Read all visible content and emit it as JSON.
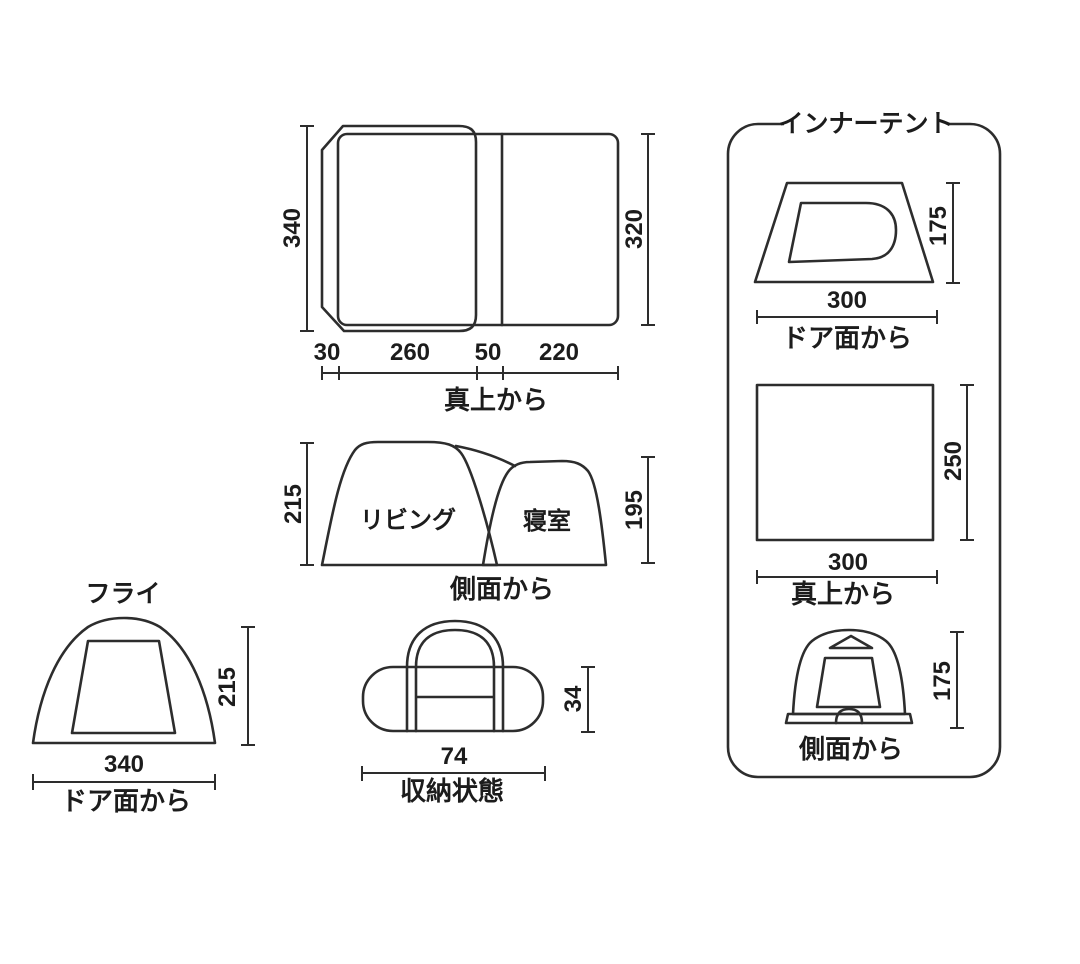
{
  "page": {
    "background": "#ffffff",
    "line_color": "#2d2d2d",
    "text_color": "#1c1c1c"
  },
  "main_tent": {
    "top_view": {
      "caption": "真上から",
      "height_left": "340",
      "height_right": "320",
      "segments": [
        "30",
        "260",
        "50",
        "220"
      ]
    },
    "side_view": {
      "caption": "側面から",
      "height_left": "215",
      "height_right": "195",
      "room_left": "リビング",
      "room_right": "寝室"
    }
  },
  "fly": {
    "title": "フライ",
    "height": "215",
    "width": "340",
    "caption": "ドア面から"
  },
  "storage": {
    "width": "74",
    "height": "34",
    "caption": "収納状態"
  },
  "inner_tent": {
    "title": "インナーテント",
    "door_view": {
      "width": "300",
      "height": "175",
      "caption": "ドア面から"
    },
    "top_view": {
      "width": "300",
      "height": "250",
      "caption": "真上から"
    },
    "side_view": {
      "height": "175",
      "caption": "側面から"
    }
  }
}
